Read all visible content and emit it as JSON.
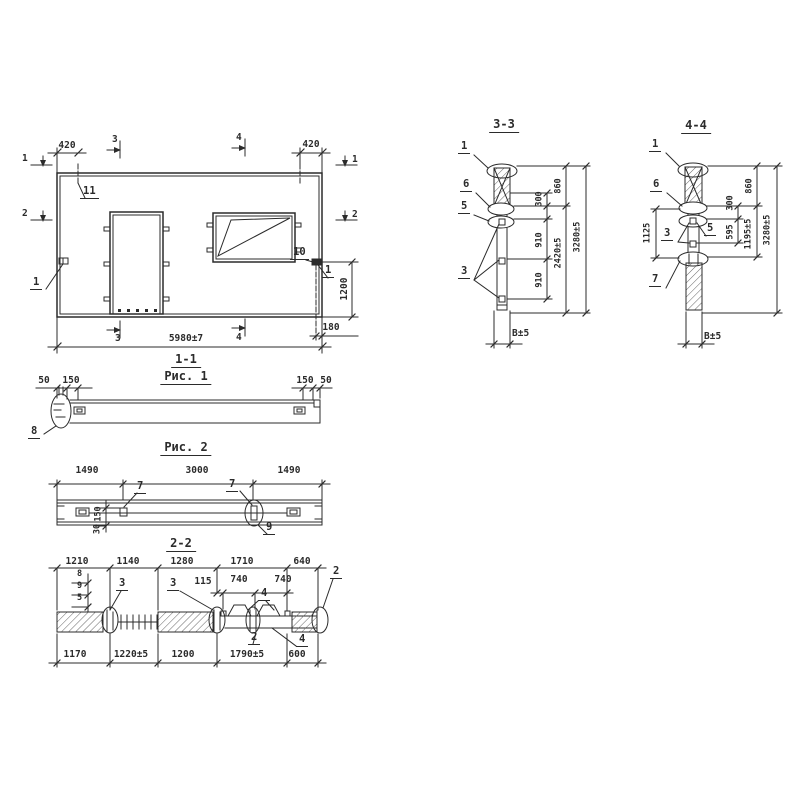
{
  "ink": "#2b2b2b",
  "views": {
    "elevation": {
      "title": "1-1",
      "caption": "Рис. 1",
      "marks": {
        "m1_left": "1",
        "m1_right": "1",
        "m2_left": "2",
        "m2_right": "2",
        "m3_top": "3",
        "m3_bottom": "3",
        "m4_top": "4",
        "m4_bottom": "4"
      },
      "dims": {
        "top_left": "420",
        "top_right": "420",
        "overall_width": "5980±7",
        "right_height": "1200",
        "right_offset": "180"
      },
      "callouts": {
        "c11": "11",
        "c1_left": "1",
        "c10": "10",
        "c1_right": "1"
      }
    },
    "section_1_1": {
      "dims": {
        "left_50": "50",
        "left_150": "150",
        "right_150": "150",
        "right_50": "50"
      },
      "callouts": {
        "c8": "8"
      }
    },
    "figure_2": {
      "caption": "Рис. 2",
      "dims": {
        "left": "1490",
        "middle": "3000",
        "right": "1490",
        "v150": "150",
        "v30": "30"
      },
      "callouts": {
        "c7_left": "7",
        "c7_right": "7",
        "c9": "9"
      }
    },
    "section_2_2": {
      "title": "2-2",
      "dims_top": [
        "1210",
        "1140",
        "1280",
        "1710",
        "640"
      ],
      "dims_sub": [
        "115",
        "740",
        "740"
      ],
      "rebar_labels": [
        "8",
        "9",
        "5"
      ],
      "callouts": {
        "c3_left": "3",
        "c3_right": "3",
        "c4_top": "4",
        "c2_right": "2",
        "c2_bottom": "2",
        "c4_bottom": "4"
      },
      "dims_bottom": [
        "1170",
        "1220±5",
        "1200",
        "1790±5",
        "600"
      ]
    },
    "section_3_3": {
      "title": "3-3",
      "callouts": {
        "c1": "1",
        "c6": "6",
        "c5": "5",
        "c3": "3"
      },
      "dims": {
        "d300": "300",
        "d860": "860",
        "d910_a": "910",
        "d910_b": "910",
        "d2420": "2420±5",
        "d3280": "3280±5",
        "thickness": "B±5"
      }
    },
    "section_4_4": {
      "title": "4-4",
      "callouts": {
        "c1": "1",
        "c6": "6",
        "c3": "3",
        "c5": "5",
        "c7": "7"
      },
      "dims": {
        "d1125": "1125",
        "d300": "300",
        "d860": "860",
        "d595": "595",
        "d1195": "1195±5",
        "d3280": "3280±5",
        "thickness": "B±5"
      }
    }
  }
}
